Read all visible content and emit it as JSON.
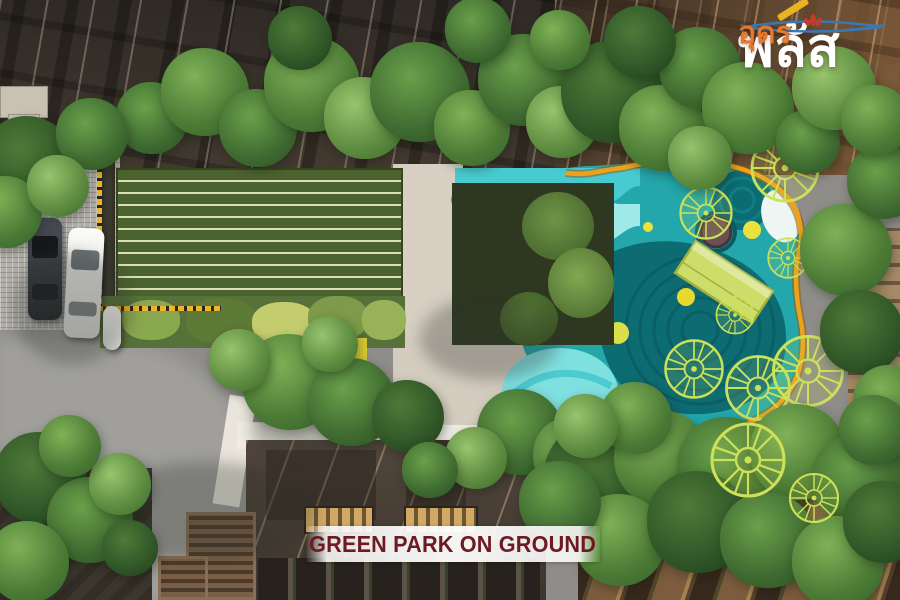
{
  "meta": {
    "kind": "aerial architectural rendering",
    "subject": "condominium courtyard green park, top-down view"
  },
  "branding": {
    "logo_primary": "พลัส",
    "logo_secondary": "อุดร",
    "logo_primary_color": "#ffffff",
    "logo_secondary_color": "#e5772e",
    "swoosh_color": "#3a78b3",
    "lotus_color": "#c43b2a"
  },
  "caption": {
    "text": "GREEN PARK ON GROUND",
    "text_color": "#6d1a22"
  },
  "palette": {
    "lawn_green": "#4b632e",
    "lawn_stripe": "#dcdfb8",
    "pool_teal": "#23a7ab",
    "pool_aqua_light": "#9fe9e8",
    "pool_teal_dark": "#0d6b72",
    "playground_lime": "#cde05a",
    "playground_border_orange": "#efa11c",
    "path_beige": "#d6cfc2",
    "road_gray": "#a09f9c",
    "roof_dark_brown": "#3e352d",
    "roof_warm_brown": "#7c5c3d",
    "tree_green": "#4d7c36",
    "dashed_edge_yellow": "#f0b429"
  },
  "scene_elements": [
    "striped-event-lawn",
    "kids-playground-splash-deck",
    "canopy-wheel-structures",
    "planting-patchwork-beds",
    "perimeter-trees",
    "driveway-with-cars",
    "residential-towers"
  ]
}
